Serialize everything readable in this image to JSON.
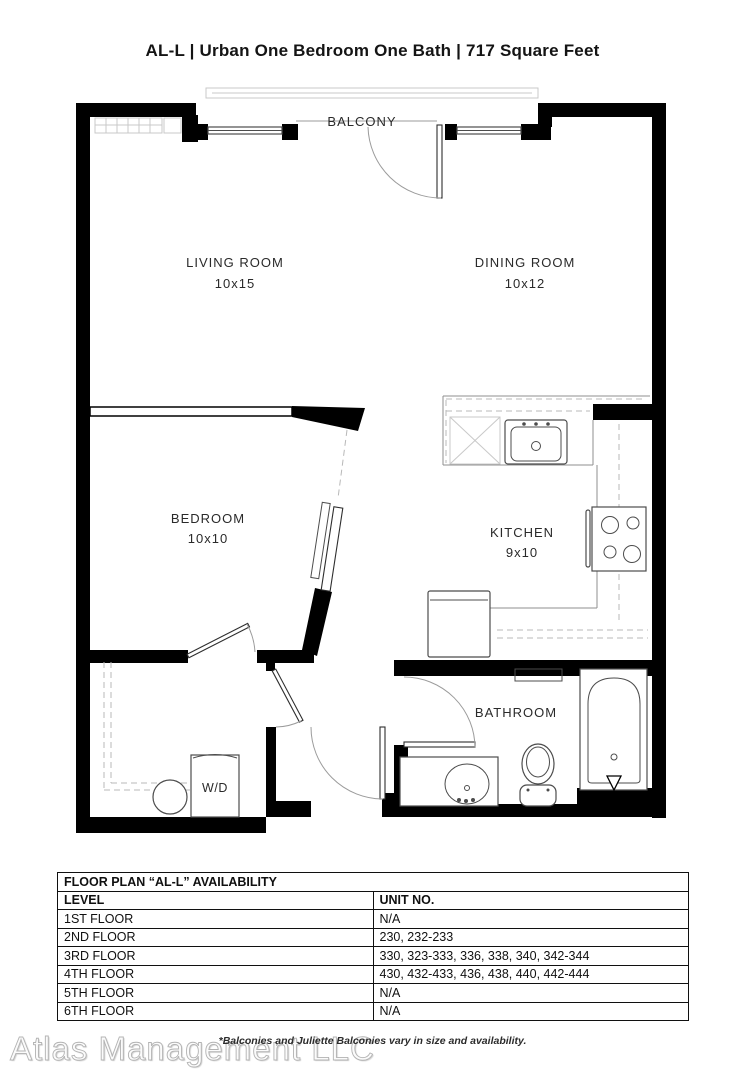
{
  "title": "AL-L | Urban One Bedroom One Bath | 717  Square Feet",
  "plan": {
    "balcony": "BALCONY",
    "laundry_label": "W/D",
    "rooms": {
      "living": {
        "name": "LIVING ROOM",
        "dims": "10x15"
      },
      "dining": {
        "name": "DINING ROOM",
        "dims": "10x12"
      },
      "bedroom": {
        "name": "BEDROOM",
        "dims": "10x10"
      },
      "kitchen": {
        "name": "KITCHEN",
        "dims": "9x10"
      },
      "bathroom": {
        "name": "BATHROOM"
      }
    }
  },
  "availability_table": {
    "title": "FLOOR PLAN “AL-L” AVAILABILITY",
    "columns": {
      "level": "LEVEL",
      "unit": "UNIT NO."
    },
    "rows": [
      {
        "level": "1ST FLOOR",
        "units": "N/A"
      },
      {
        "level": "2ND FLOOR",
        "units": "230, 232-233"
      },
      {
        "level": "3RD FLOOR",
        "units": "330, 323-333, 336, 338, 340, 342-344"
      },
      {
        "level": "4TH FLOOR",
        "units": "430, 432-433, 436, 438, 440, 442-444"
      },
      {
        "level": "5TH FLOOR",
        "units": "N/A"
      },
      {
        "level": "6TH FLOOR",
        "units": "N/A"
      }
    ]
  },
  "footer": {
    "disclaimer": "*Balconies and Juliette Balconies vary in size and availability.",
    "watermark": "Atlas Management LLC"
  },
  "colors": {
    "wall": "#000000",
    "fixture_line": "#4c4c4c",
    "light_line": "#c9c9c9",
    "text": "#141414"
  }
}
